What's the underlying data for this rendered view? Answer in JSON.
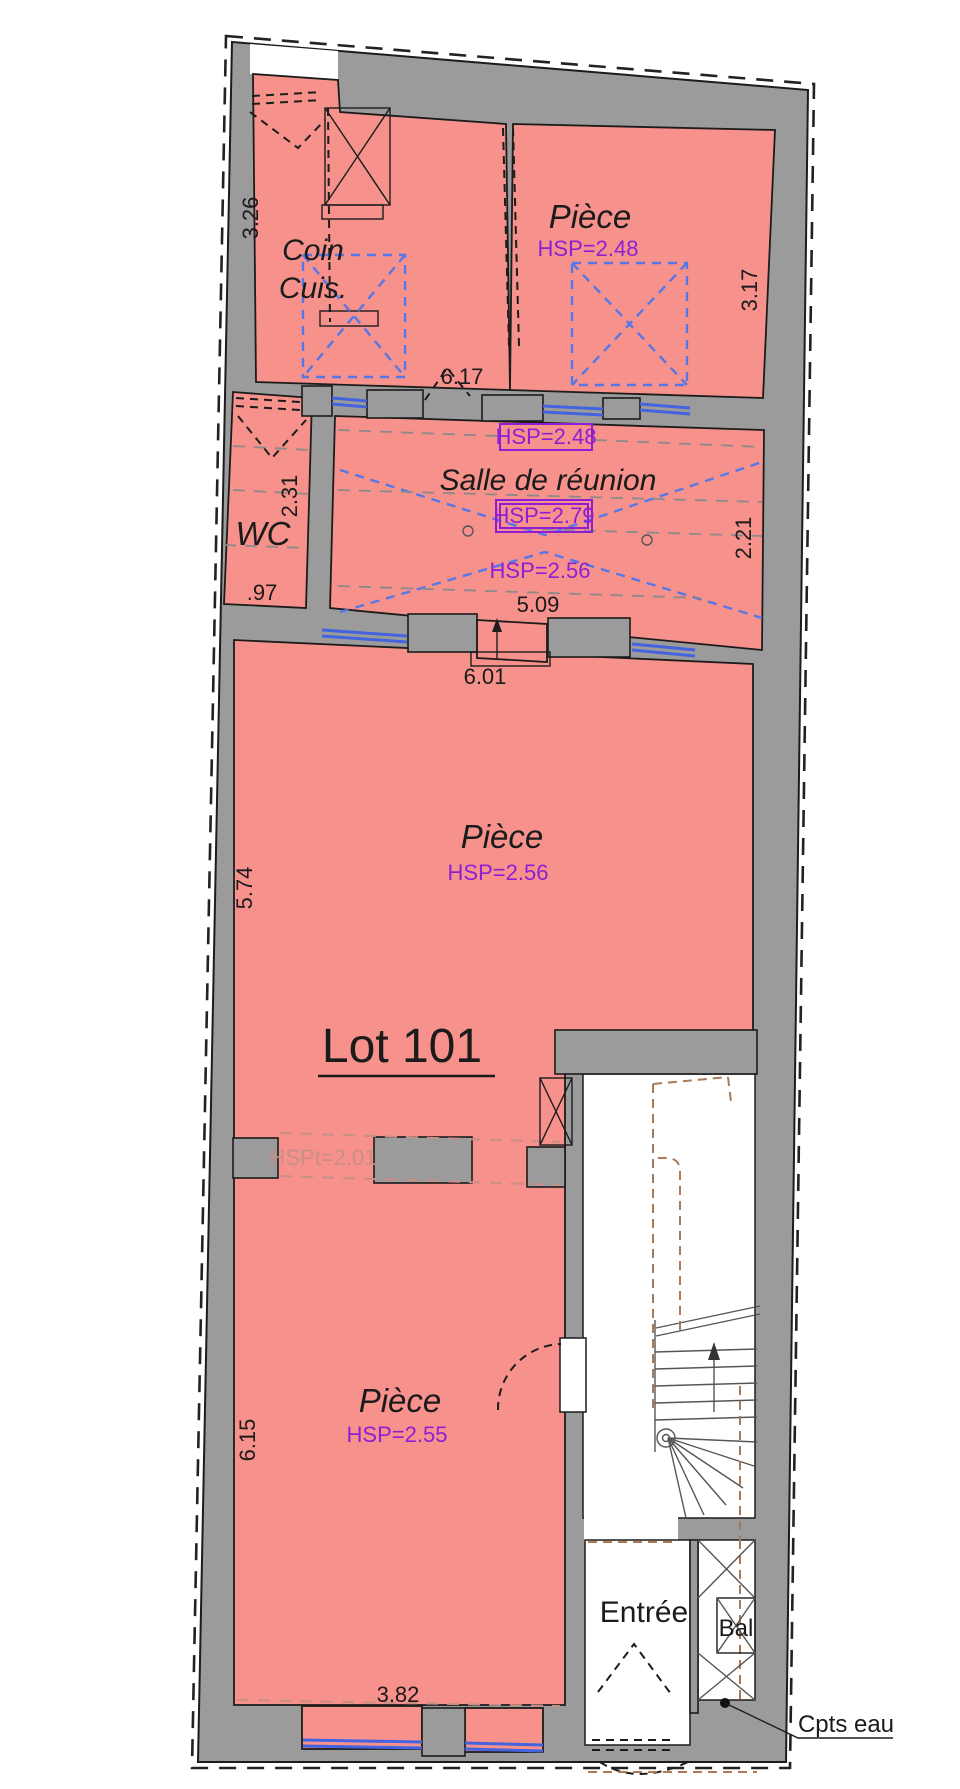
{
  "plan": {
    "lot_title": "Lot 101",
    "rooms": {
      "coin_cuis": {
        "line1": "Coin",
        "line2": "Cuis."
      },
      "piece_top": {
        "name": "Pièce",
        "hsp": "HSP=2.48"
      },
      "salle_reunion": {
        "name": "Salle de réunion",
        "hsp_boxed_top": "HSP=2.48",
        "hsp_boxed_mid": "HSP=2.79",
        "hsp_low": "HSP=2.56"
      },
      "wc": {
        "name": "WC"
      },
      "piece_central": {
        "name": "Pièce",
        "hsp": "HSP=2.56"
      },
      "piece_bottom": {
        "name": "Pièce",
        "hsp": "HSP=2.55"
      },
      "entree": {
        "name": "Entrée"
      },
      "bal": {
        "name": "Bal"
      }
    },
    "annotations": {
      "hspt": "HSPt=2.01",
      "cpts_eau": "Cpts eau"
    },
    "dims": {
      "d326": "3.26",
      "d317": "3.17",
      "d617": "6.17",
      "d231": "2.31",
      "d097": ".97",
      "d221": "2.21",
      "d509": "5.09",
      "d601": "6.01",
      "d574": "5.74",
      "d615": "6.15",
      "d382": "3.82"
    },
    "colors": {
      "room_fill": "#F6918B",
      "wall_fill": "#9B9B9B",
      "ceiling_blue": "#5577E8",
      "window_blue": "#4463DE",
      "hsp_purple": "#8E1FD6",
      "lot_brown": "#A97A5A",
      "beam_red": "#C98F86"
    }
  }
}
